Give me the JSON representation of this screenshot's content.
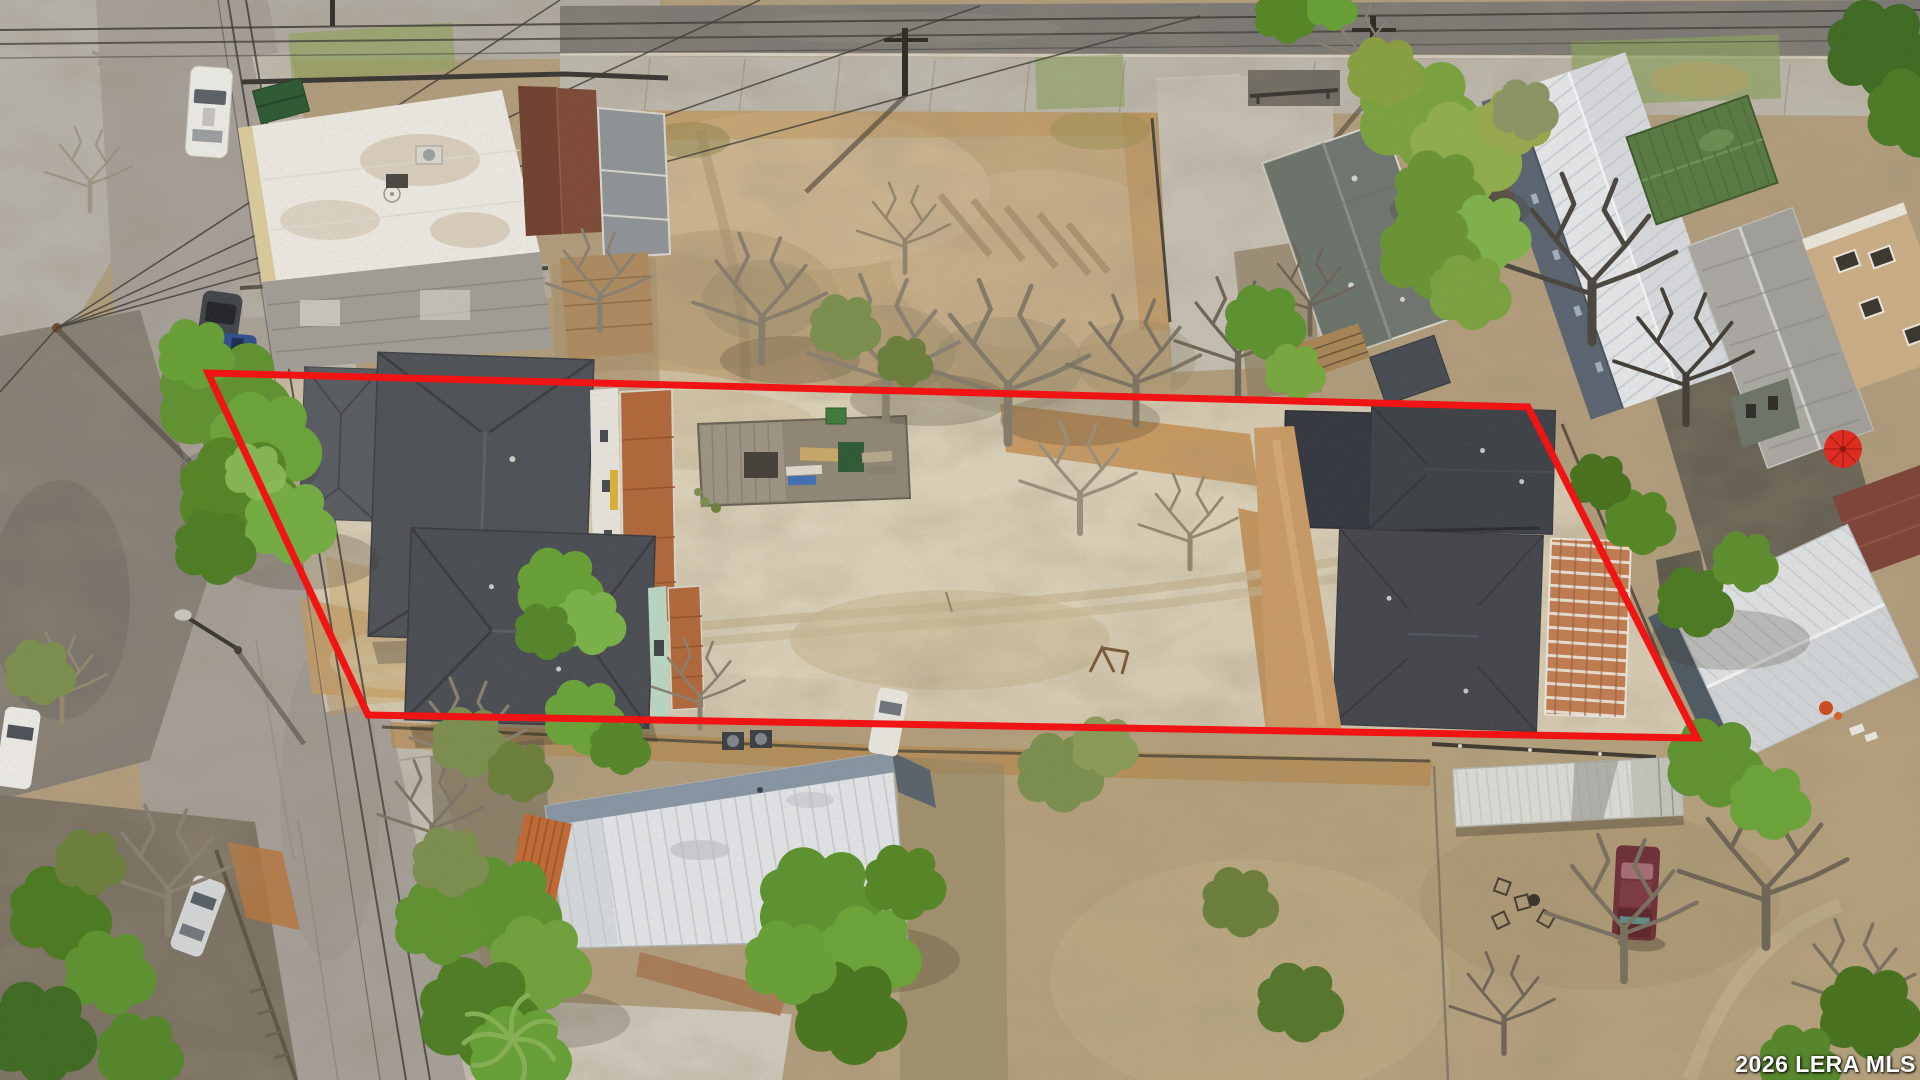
{
  "watermark": {
    "text": "2026 LERA MLS",
    "color": "#ffffff"
  },
  "boundary": {
    "color": "#f01414",
    "label": "property boundary outline"
  },
  "scene": {
    "kind": "aerial-drone-photo",
    "subject": "vacant lot outlined in red"
  }
}
